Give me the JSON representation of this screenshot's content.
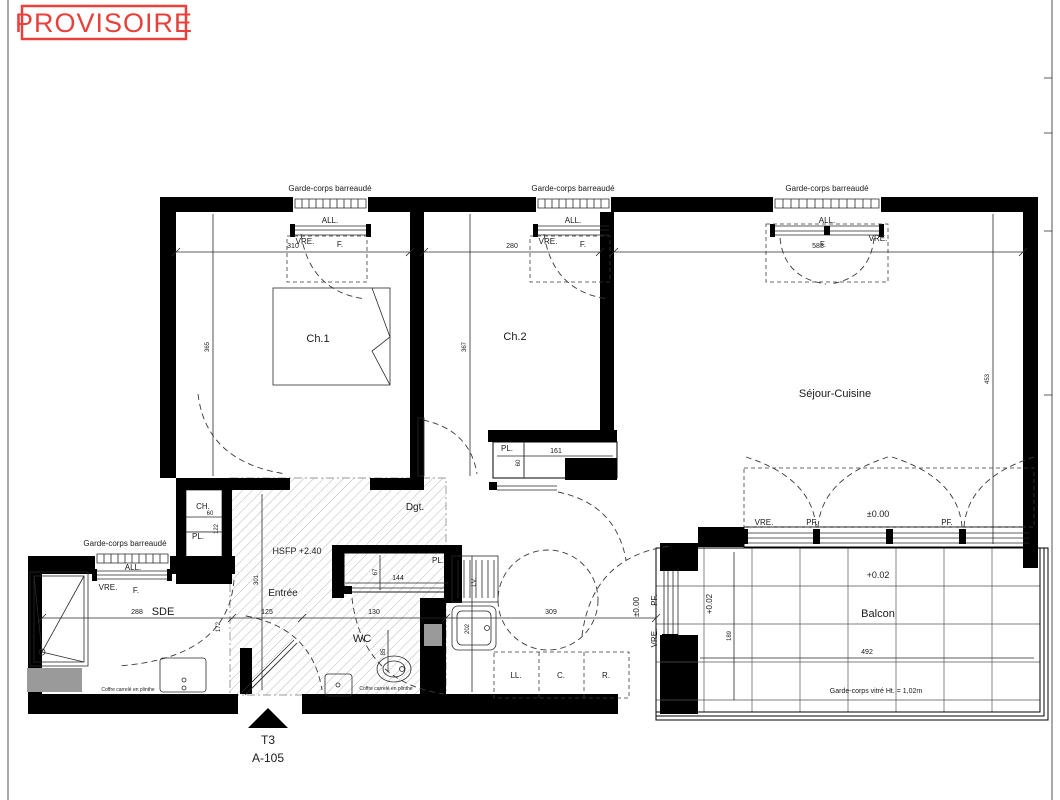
{
  "stamp": {
    "label": "PROVISOIRE",
    "color": "#e8413c"
  },
  "unit": {
    "type": "T3",
    "lot": "A-105"
  },
  "rooms": {
    "ch1": "Ch.1",
    "ch2": "Ch.2",
    "sejour": "Séjour-Cuisine",
    "dgt": "Dgt.",
    "entree": "Entrée",
    "sde": "SDE",
    "wc": "WC",
    "balcon": "Balcon"
  },
  "closets": {
    "pl": "PL.",
    "ch": "CH."
  },
  "openings": {
    "guard_rail": "Garde-corps barreaudé",
    "glass_guard": "Garde-corps vitré Ht. = 1,02m",
    "sill": "ALL.",
    "shutter": "VRE.",
    "window": "F.",
    "french_window": "PF."
  },
  "levels": {
    "ceiling": "HSFP +2.40",
    "zero": "±0.00",
    "balcony": "+0.02"
  },
  "appliances": {
    "washer": "LL.",
    "cooker": "C.",
    "fridge": "R.",
    "dishwasher": "LV."
  },
  "notes": {
    "tiled_box": "Coffre carrelé en plinthe"
  },
  "dims": {
    "ch1_w": "310",
    "ch2_w": "280",
    "sejour_w": "583",
    "ch1_h": "365",
    "ch2_h": "367",
    "sejour_h": "453",
    "pl_ch2_w": "161",
    "pl_ch2_d": "60",
    "ch_w": "60",
    "ch_d": "122",
    "hall_h": "301",
    "sde_w": "288",
    "sde_d": "172",
    "entree_w": "125",
    "wc_w": "130",
    "wc_d": "85",
    "pl_wc_d": "67",
    "pl_wc_w": "144",
    "kitchen_d": "202",
    "kitchen_w": "309",
    "balcon_w": "492",
    "balcon_d": "189"
  }
}
